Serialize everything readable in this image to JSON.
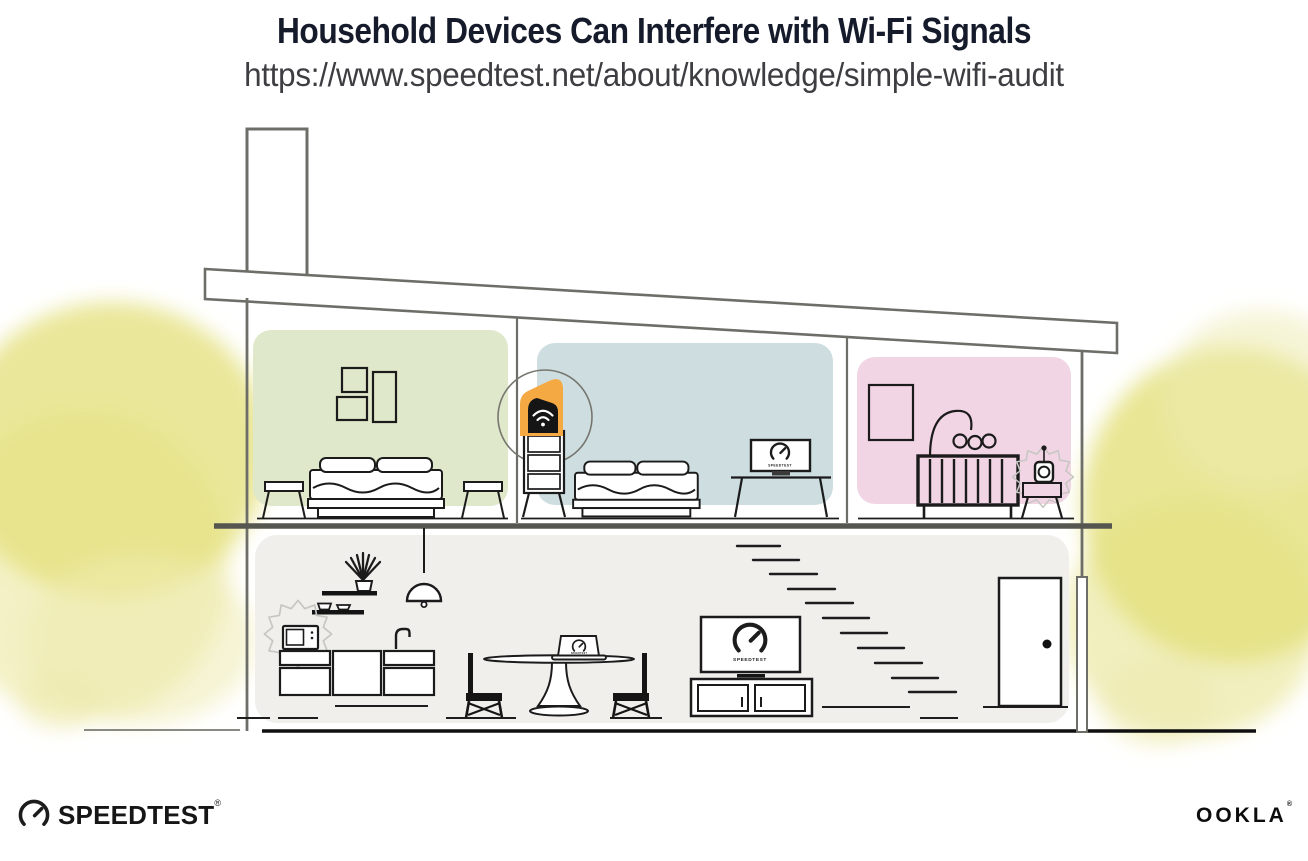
{
  "header": {
    "title": "Household Devices Can Interfere with Wi-Fi Signals",
    "url": "https://www.speedtest.net/about/knowledge/simple-wifi-audit"
  },
  "illustration": {
    "description": "Cross-section of a two-story house; a highlighted Wi-Fi router upstairs, with a microwave and a baby monitor shown emitting interference",
    "labels": {
      "screen_brand": "SPEEDTEST"
    },
    "colors": {
      "bedroom_left": "#dfe8ca",
      "bedroom_middle": "#cddde0",
      "nursery": "#f2d5e4",
      "downstairs": "#f0efec",
      "router_highlight": "#f4a943",
      "foliage": "#e4e07e",
      "foliage_light": "#eeebb0",
      "wall_outline": "#6e6e69",
      "ink": "#151515",
      "interference_outline": "#c6c6c2"
    },
    "rooms": [
      {
        "name": "bedroom-left"
      },
      {
        "name": "bedroom-middle"
      },
      {
        "name": "nursery"
      },
      {
        "name": "downstairs-living-area"
      }
    ],
    "devices": [
      {
        "name": "wifi-router",
        "highlighted": true
      },
      {
        "name": "desk-monitor",
        "screen": "speedtest-gauge"
      },
      {
        "name": "microwave",
        "interference": true
      },
      {
        "name": "baby-monitor",
        "interference": true
      },
      {
        "name": "tv",
        "screen": "speedtest-gauge"
      },
      {
        "name": "dining-laptop",
        "screen": "speedtest-gauge"
      }
    ]
  },
  "footer": {
    "speedtest": {
      "label": "SPEEDTEST",
      "registered": "®"
    },
    "ookla": {
      "label": "OOKLA",
      "registered": "®"
    }
  }
}
